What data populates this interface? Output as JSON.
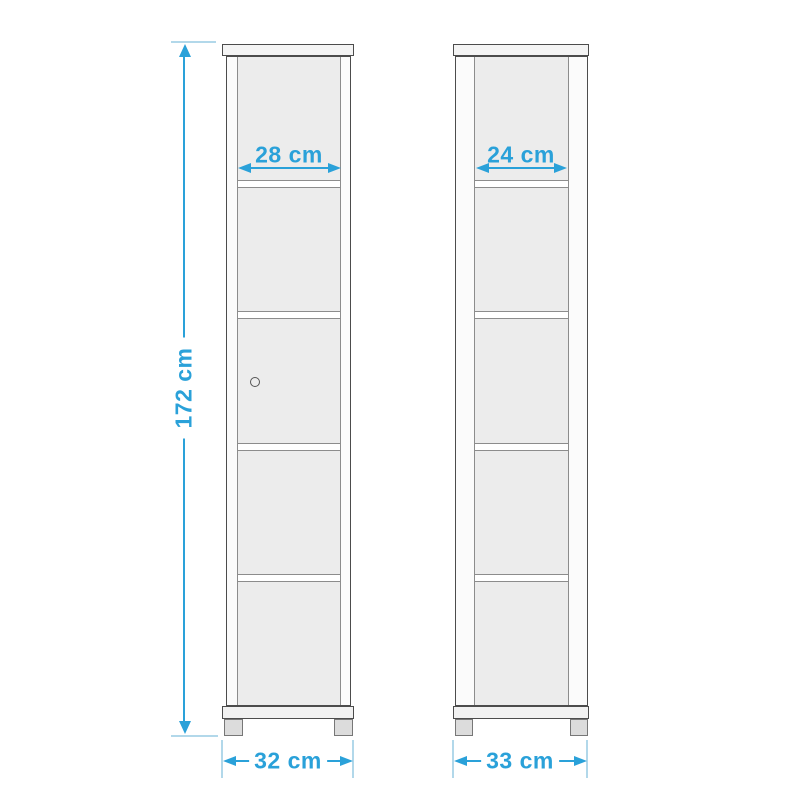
{
  "diagram": {
    "colors": {
      "accent": "#2AA1D9",
      "light_line": "#B2D8EA"
    },
    "height_dimension": {
      "label": "172 cm"
    },
    "front_view": {
      "inner_width_label": "28 cm",
      "outer_width_label": "32 cm",
      "compartments": 5,
      "has_door_knob": true
    },
    "side_view": {
      "inner_depth_label": "24 cm",
      "outer_depth_label": "33 cm",
      "compartments": 5
    }
  }
}
